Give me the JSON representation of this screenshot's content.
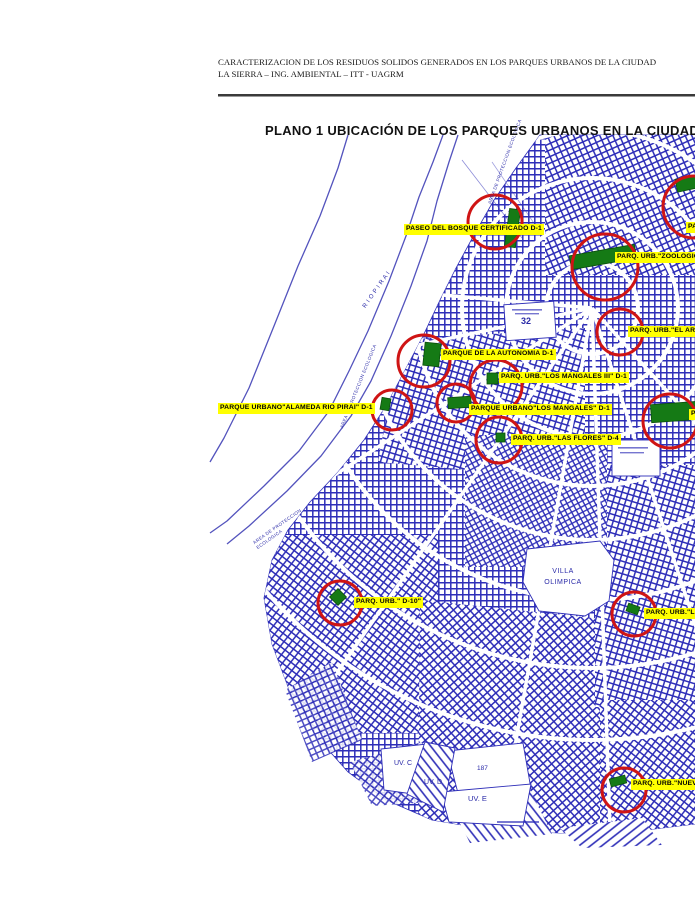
{
  "header": {
    "line1": "CARACTERIZACION DE LOS RESIDUOS SOLIDOS GENERADOS EN LOS PARQUES URBANOS DE LA CIUDAD",
    "line2": "LA SIERRA – ING. AMBIENTAL – ITT -  UAGRM"
  },
  "map": {
    "title": "PLANO 1 UBICACIÓN DE LOS PARQUES URBANOS EN LA CIUDAD",
    "park_labels": [
      {
        "text": "PASEO  DEL BOSQUE CERTIFICADO  D-1"
      },
      {
        "text": "PARQ. URB.\"ZOOLOGIC"
      },
      {
        "text": "PA"
      },
      {
        "text": "PARQ. URB.\"EL ARE"
      },
      {
        "text": "PARQUE DE LA AUTONOMIA D-1"
      },
      {
        "text": "PARQ. URB.\"LOS MANGALES III\" D-1"
      },
      {
        "text": "PARQUE URBANO\"ALAMEDA RIO PIRAI\" D-1"
      },
      {
        "text": "PARQUE URBANO\"LOS MANGALES\" D-1"
      },
      {
        "text": "PARQ. URB.\"LAS FLORES\" D-4"
      },
      {
        "text": "PARQ. URB.\" D-10\""
      },
      {
        "text": "PARQ. URB.\"LO"
      },
      {
        "text": "PARQ. URB.\"NUEV"
      },
      {
        "text": "P"
      }
    ],
    "area_labels": {
      "villa_olimpica": "VILLA\nOLIMPICA",
      "uv_c": "UV. C",
      "uv_d": "UV. D",
      "uv_e": "UV. E",
      "n187": "187",
      "n32": "32",
      "rio_pirai": "R I O   P I R A I",
      "proteccion_1": "AREA DE PROTECCION ECOLOGICA",
      "proteccion_2": "AREA DE PROTECCION ECOLOGICA",
      "proteccion_3": "AREA DE PROTECCION\nECOLOGICA"
    },
    "colors": {
      "street_blue": "#2e2eb8",
      "river_blue": "#5353bd",
      "marker_red": "#cf1414",
      "park_green": "#157a15",
      "label_yellow": "#ffff00"
    }
  }
}
